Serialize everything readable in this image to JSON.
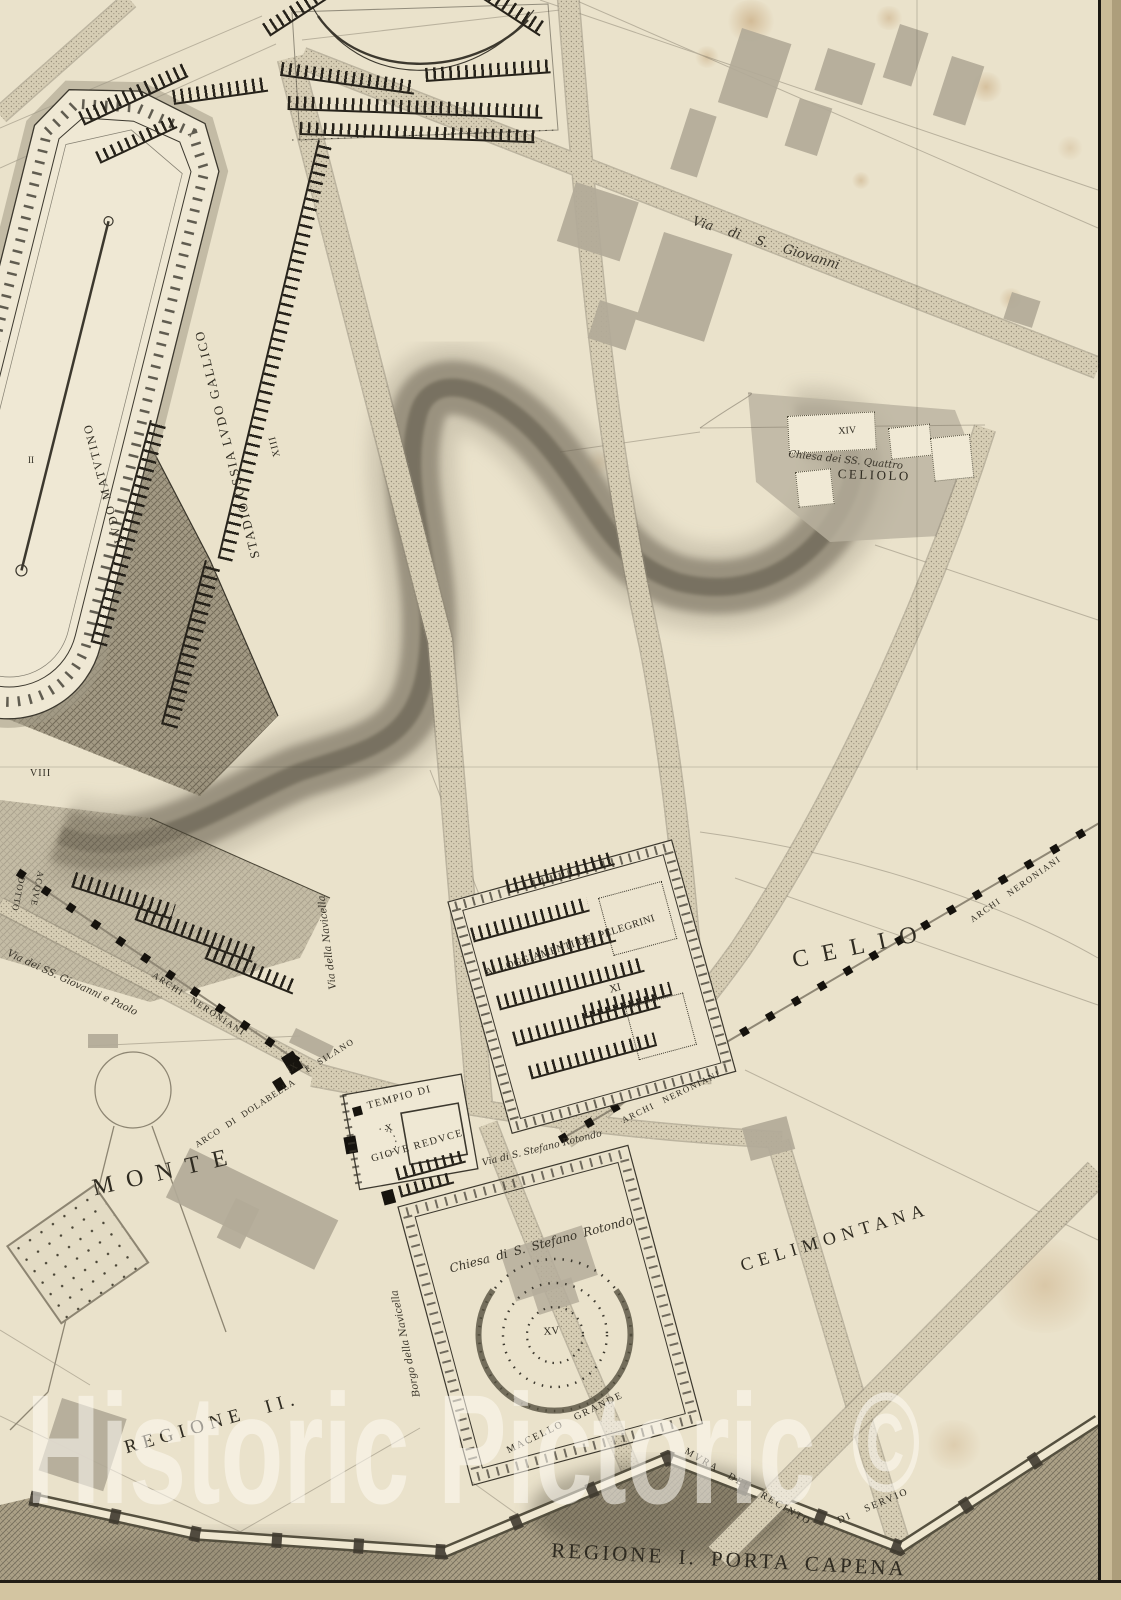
{
  "page": {
    "type": "engraved-antique-map",
    "subject": "Plan of ancient Rome — Regione I Porta Capena / Regione II Celimontana",
    "region_title": "REGIONE I. PORTA CAPENA"
  },
  "watermark": {
    "text": "Historic Pictoric",
    "symbol": "©"
  },
  "labels": {
    "stadio": "STADIO OSSIA LVDO GALLICO",
    "stadio_numeral": "XIII",
    "ludo_matutino": "LVDO MATVTINO",
    "numeral_ii": "II",
    "numeral_viii": "VIII",
    "via_s_giovanni": "Via di S. Giovanni",
    "numeral_xiv": "XIV",
    "chiesa_ss_quattro": "Chiesa dei SS. Quattro",
    "celiolo": "CELIOLO",
    "alloggiamenti": "ALLOGGIAMENTI DEI PELEGRINI",
    "numeral_xi": "XI",
    "celio": "CELIO",
    "archi_neroniani_right": "ARCHI NERONIANI",
    "archi_neroniani_center": "ARCHI NERONIANI",
    "archi_neroniani_left": "ARCHI NERONIANI",
    "acquedotto_line1": "ACQVE",
    "acquedotto_line2": "DOTTO",
    "via_ss_giovanni_paolo": "Via dei SS. Giovanni e Paolo",
    "via_della_navicella": "Via della Navicella",
    "arco_di_dolabella": "ARCO DI DOLABELLA",
    "numeral_ix": "IX",
    "e_silano": "E. SILANO",
    "tempio_di": "TEMPIO DI",
    "numeral_x": "X",
    "giove_reduce": "GIOVE REDVCE",
    "via_s_stefano": "Via di S. Stefano Rotondo",
    "monte": "MONTE",
    "celimontana": "CELIMONTANA",
    "chiesa_s_stefano": "Chiesa di S. Stefano Rotondo",
    "numeral_xv": "XV",
    "borgo_della_navicella": "Borgo della Navicella",
    "regione_ii": "REGIONE II.",
    "macello_grande": "MACELLO GRANDE",
    "mura_del_recinto": "MVRA DEL RECINTO",
    "di_servio": "DI SERVIO",
    "regione_i_porta_capena": "REGIONE I. PORTA CAPENA"
  },
  "colors": {
    "paper": "#eae2cb",
    "ink": "#3a362b",
    "road_fill": "#d6cdb4",
    "gray_building": "#b2aa98",
    "valley_shade": "#6b6454",
    "stain": "#b9824a",
    "watermark": "#ffffff"
  }
}
